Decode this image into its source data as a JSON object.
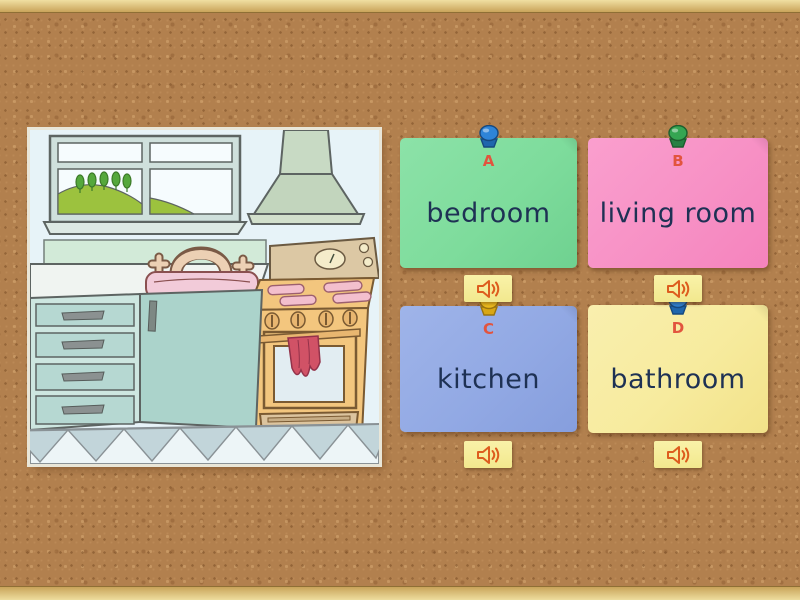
{
  "board": {
    "cork_color": "#b2804e",
    "frame_color": "#dcc178",
    "frame_sides": [
      "top",
      "bottom"
    ]
  },
  "question": {
    "illustration": "kitchen-scene",
    "depicts": "cartoon kitchen: window with hill and trees, extractor hood, sink with faucet, orange stove with red towel, teal cabinet drawers, zigzag floor trim"
  },
  "cards": [
    {
      "letter": "A",
      "label": "bedroom",
      "color": "#7edc9c",
      "pin_color": "blue"
    },
    {
      "letter": "B",
      "label": "living room",
      "color": "#f791c5",
      "pin_color": "green"
    },
    {
      "letter": "C",
      "label": "kitchen",
      "color": "#92a9e4",
      "pin_color": "yellow"
    },
    {
      "letter": "D",
      "label": "bathroom",
      "color": "#f7eb9e",
      "pin_color": "blue"
    }
  ],
  "text_colors": {
    "letter": "#e2543e",
    "word": "#1e3154"
  },
  "audio_button": {
    "icon": "speaker-icon",
    "background": "#f7f09e",
    "glyph_color": "#dd5c1e",
    "count": 4
  }
}
